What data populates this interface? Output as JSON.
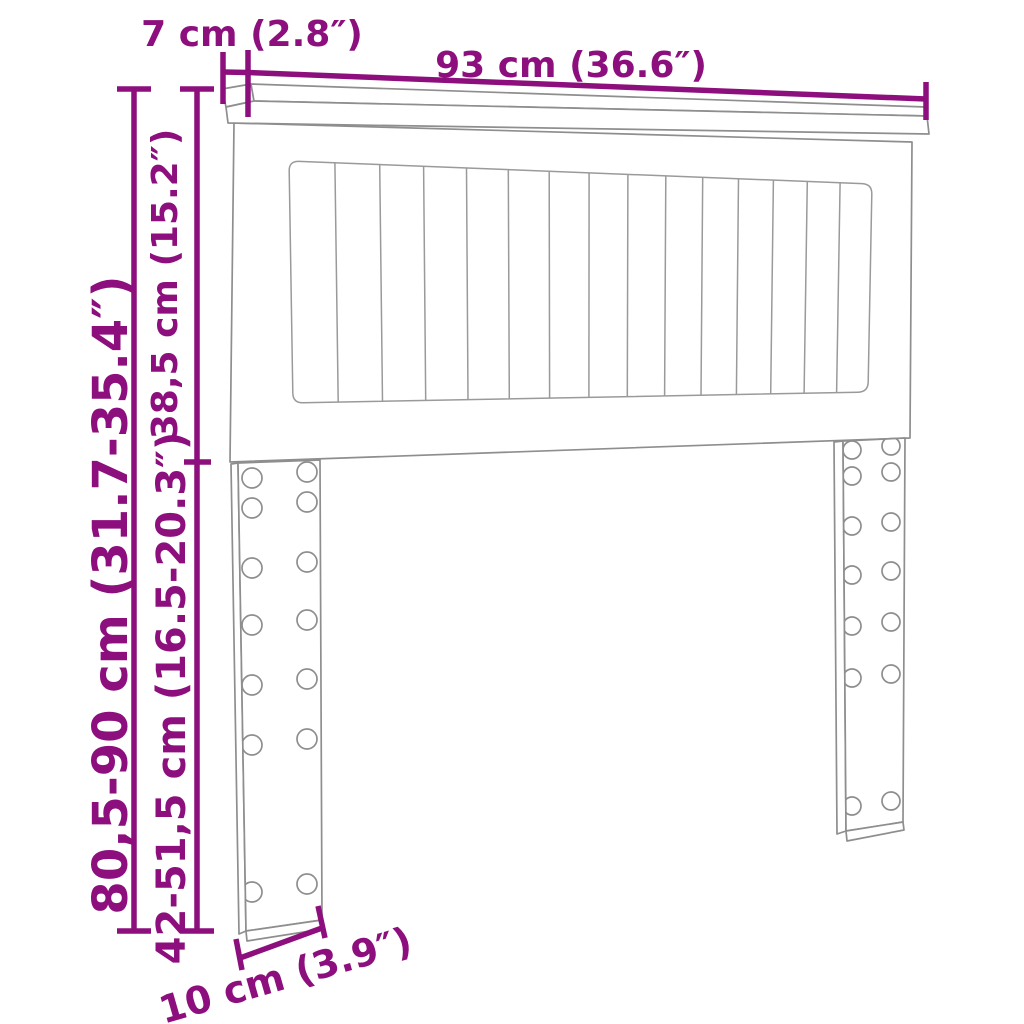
{
  "title": "Headboard dimension diagram",
  "accent_color": "#8C0F7D",
  "outline_color": "#8E8E8E",
  "background_color": "#FFFFFF",
  "labels": {
    "top_depth": "7 cm (2.8″)",
    "width": "93 cm (36.6″)",
    "panel_height": "38,5 cm (15.2″)",
    "total_height": "80,5-90 cm (31.7-35.4″)",
    "leg_height": "42-51,5 cm (16.5-20.3″)",
    "leg_width": "10 cm (3.9″)"
  },
  "figure": {
    "product": "headboard",
    "slat_columns": 15,
    "legs": 2,
    "hole_rows_per_leg": 7,
    "hole_columns_per_leg": 2
  }
}
